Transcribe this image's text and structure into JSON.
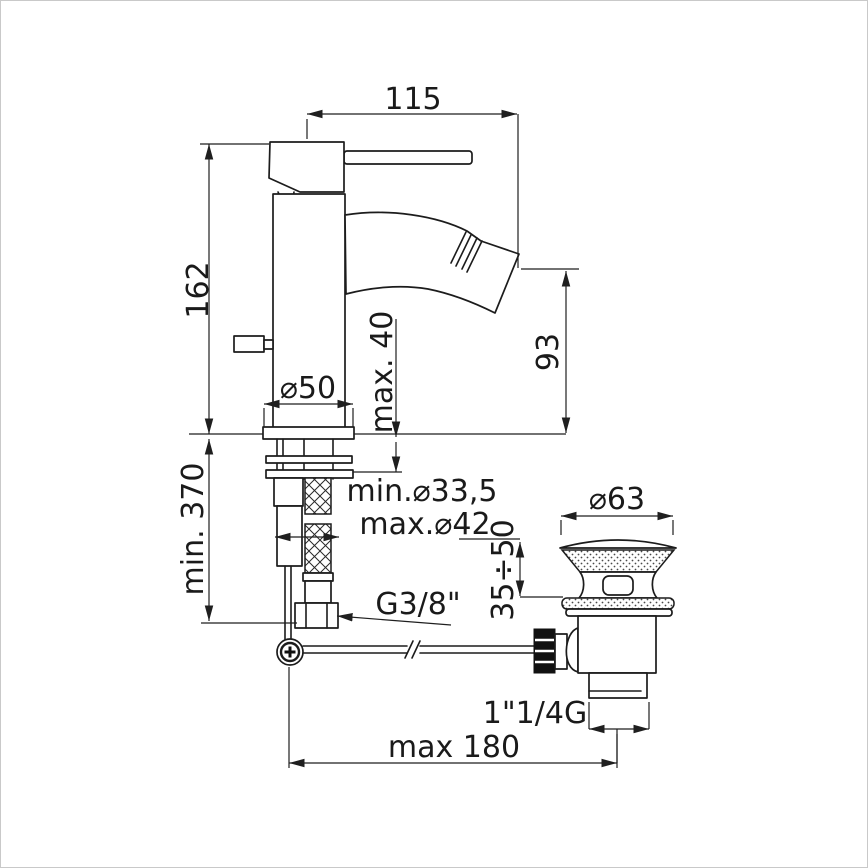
{
  "drawing": {
    "title": "bidet single-lever mixer with pop-up waste - installation dimensions",
    "background_color": "#ffffff",
    "line_color": "#1c1c1c",
    "labels": {
      "spout_reach": "115",
      "body_height": "162",
      "deck_thickness": "max. 40",
      "spout_height": "93",
      "base_diameter": "⌀50",
      "hose_length": "min. 370",
      "hole_min": "min.⌀33,5",
      "hole_max": "max.⌀42",
      "hose_thread": "G3/8\"",
      "waste_flange_diameter": "⌀63",
      "rim_thickness": "35÷50",
      "waste_thread": "1\"1/4G",
      "rod_reach": "max 180"
    }
  }
}
